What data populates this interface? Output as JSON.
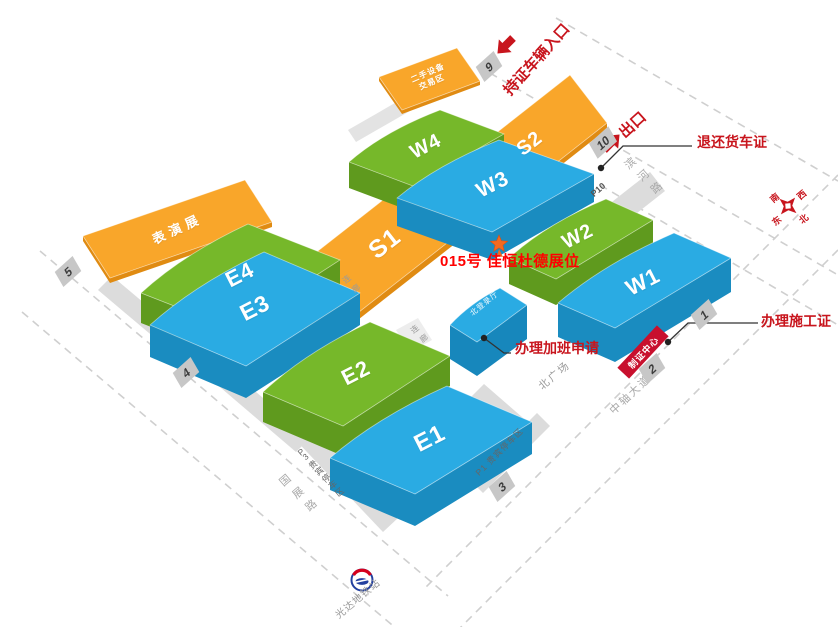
{
  "halls": {
    "e1": "E1",
    "e2": "E2",
    "e3": "E3",
    "e4": "E4",
    "w1": "W1",
    "w2": "W2",
    "w3": "W3",
    "w4": "W4",
    "s1": "S1",
    "s2": "S2"
  },
  "areas": {
    "performance": "表演展",
    "secondhand1": "二手设备",
    "secondhand2": "交易区",
    "north_login_hall": "北登录厅",
    "north_square": "北广场",
    "corridor": "连廊"
  },
  "parking": {
    "p10": "P10",
    "p3": "P3 贵宾停车区",
    "p1": "P1 贵宾停车区"
  },
  "gates": {
    "g1": "1",
    "g2": "2",
    "g3": "3",
    "g4": "4",
    "g5": "5",
    "g9": "9",
    "g10": "10"
  },
  "roads": {
    "binhe": "滨河路",
    "zhongzhou": "中轴大道",
    "guozhan": "国展路"
  },
  "station": {
    "name": "光达地铁站"
  },
  "annotations": {
    "entrance": "持证车辆入口",
    "exit": "出口",
    "return_truck_pass": "退还货车证",
    "construction_permit": "办理施工证",
    "overtime_request": "办理加班申请",
    "booth": "015号 佳恒杜德展位",
    "cert_center": "制证中心"
  },
  "compass": {
    "north": "北",
    "south": "南",
    "east": "东",
    "west": "西"
  },
  "colors": {
    "hall_blue": "#2aabe3",
    "hall_blue_side": "#1a8cc0",
    "hall_green": "#76b82a",
    "hall_green_side": "#5f9a1e",
    "hall_orange": "#f9a62a",
    "hall_orange_side": "#e08b12",
    "annotation_red": "#c8151d",
    "booth_red": "#ff0000",
    "road_gray": "#cfcfcf",
    "strip_gray": "#dcdcdc"
  }
}
